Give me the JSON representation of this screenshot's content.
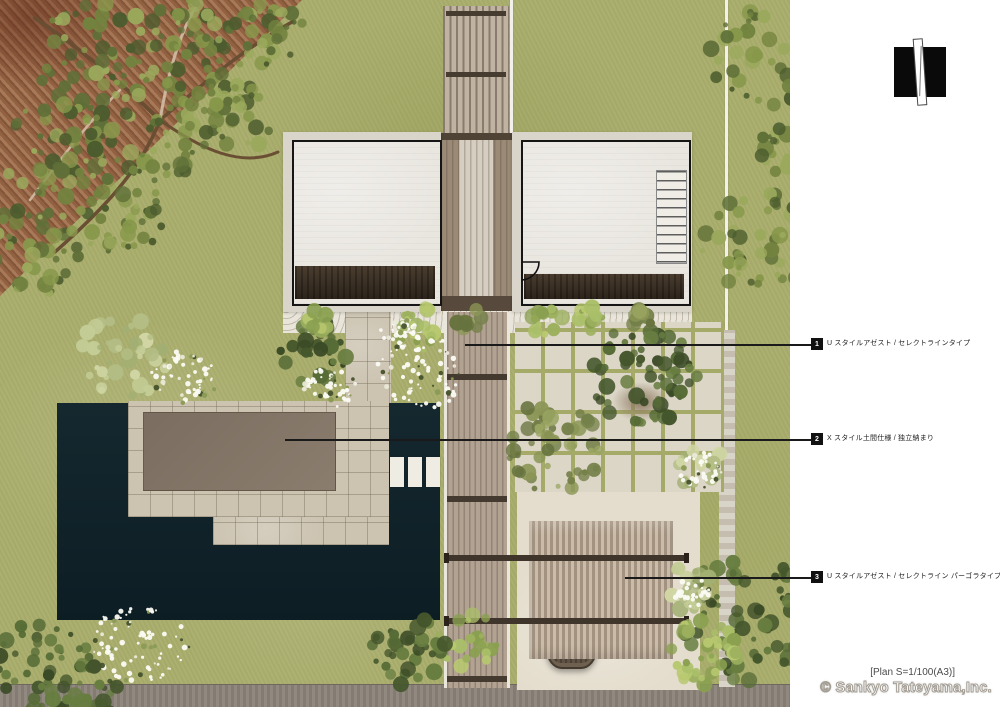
{
  "annotations": [
    {
      "num": "1",
      "label": "U スタイルアゼスト / セレクトラインタイプ"
    },
    {
      "num": "2",
      "label": "X スタイル土間仕様 / 独立納まり"
    },
    {
      "num": "3",
      "label": "U スタイルアゼスト / セレクトライン パーゴラタイプ"
    }
  ],
  "footer": {
    "scale_note": "[Plan S=1/100(A3)]",
    "copyright": "© Sankyo Tateyama,Inc."
  },
  "palette": {
    "lawn": "#a9ad6c",
    "tilled_soil": "#9a6847",
    "deck_navy": "#12242c",
    "road_gray": "#8b8379",
    "building_floor": "#e9e6e0",
    "wood_path": "#b2a292",
    "canopy_roof": "#837466",
    "paving_tile": "#dcd6c7",
    "annotation_ink": "#1a1a1a"
  }
}
